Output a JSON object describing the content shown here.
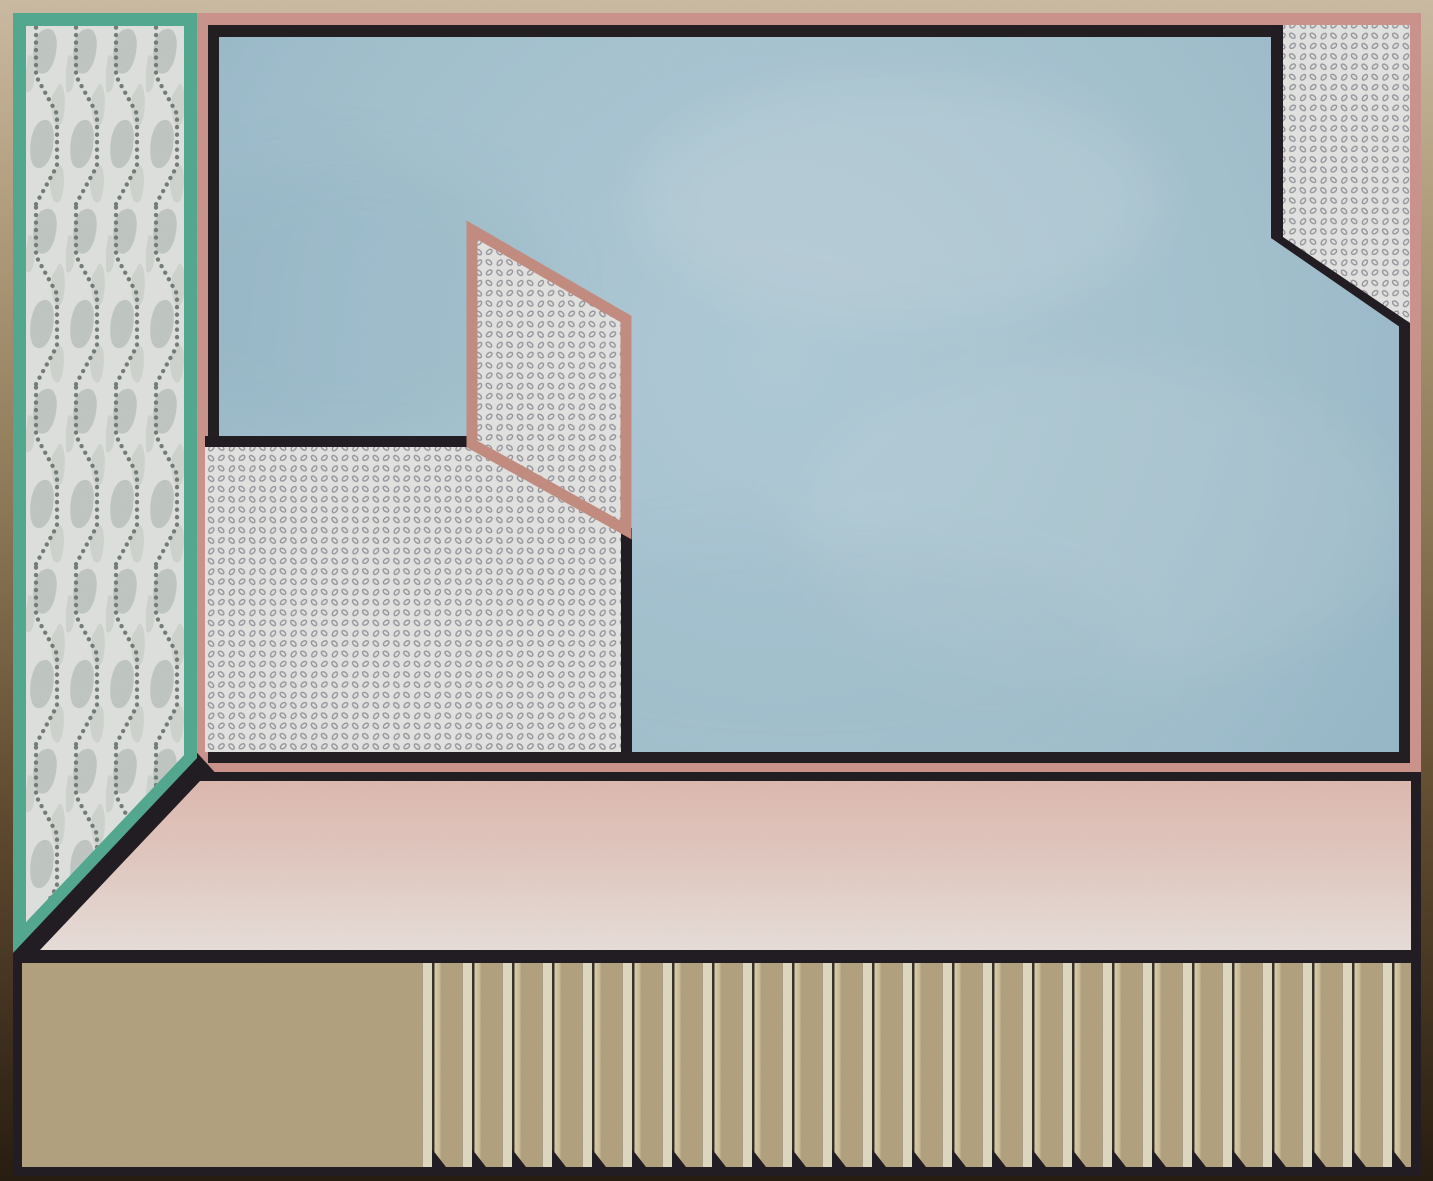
{
  "scene": {
    "title": "Abstract geometric interior composition",
    "regions": [
      {
        "name": "outer-frame",
        "label": "Border frame fading from beige at top to dark brown at bottom"
      },
      {
        "name": "left-wallpaper-panel",
        "label": "Teal-bordered vertical panel with leaf shapes and dotted zigzag chains"
      },
      {
        "name": "wall",
        "label": "Large wall framed in salmon pink and black"
      },
      {
        "name": "blue-wall-area",
        "label": "Light blue watercolor wall surface"
      },
      {
        "name": "dotted-corner",
        "label": "Dotted-ring patterned polygon in the top right corner"
      },
      {
        "name": "dotted-lower-wall",
        "label": "Dotted-ring patterned lower-left wall section"
      },
      {
        "name": "pink-parallelogram",
        "label": "Pink-outlined parallelogram filled with the dotted pattern"
      },
      {
        "name": "floor",
        "label": "Pink floor strip fading lighter toward its base"
      },
      {
        "name": "slatted-base",
        "label": "Tan base band with vertical cream slats and notched shadows"
      }
    ]
  },
  "colors": {
    "frame_top": "#ddccb1",
    "frame_upper_mid": "#c2ad88",
    "frame_mid": "#9c8660",
    "frame_lower_mid": "#6b5436",
    "frame_bottom": "#2c2013",
    "teal": "#5cb99e",
    "panel_bg": "#f3f5f2",
    "panel_motif": "#d2dad5",
    "panel_motif_light": "#e2e7e2",
    "panel_dots": "#7f8a84",
    "pink_border": "#dda29a",
    "parallelogram_pink": "#d69b8d",
    "ink_black": "#262126",
    "wall_blue_light": "#c0dcea",
    "wall_blue": "#b4d4e2",
    "wall_blue_edge": "#a4c7d8",
    "dots_bg": "#f8f8f6",
    "dots_ink": "#a3a3ab",
    "floor_top": "#f2cbc1",
    "floor_mid": "#f7ddd4",
    "floor_bottom": "#fdf3ee",
    "fence_tan": "#c4b18b",
    "slat_cream": "#f4edd3",
    "slat_cream_edge": "#9a8c6b",
    "slat_shade": "#eee2c0",
    "slat_shade_dark": "#d9caa1",
    "slat_edge": "#3f382c"
  }
}
